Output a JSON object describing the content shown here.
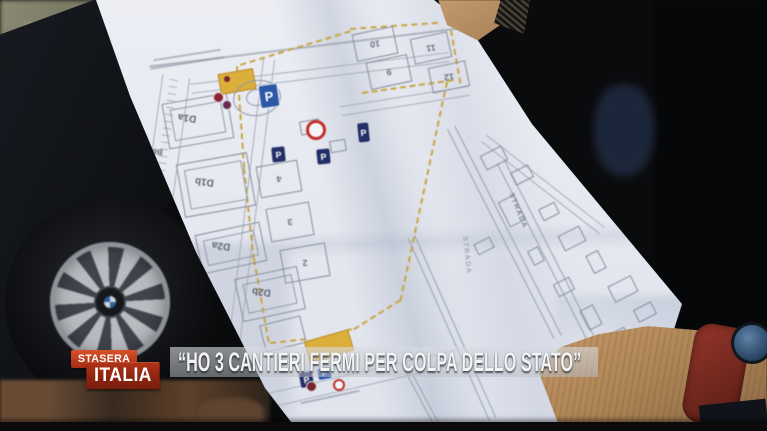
{
  "broadcast": {
    "logo": {
      "line1": "STASERA",
      "line2": "ITALIA"
    },
    "quote": "“HO 3 CANTIERI FERMI PER COLPA DELLO STATO”"
  },
  "map": {
    "labels": {
      "d1a": "D1a",
      "b8c": "B8c",
      "d1b": "D1b",
      "d2a": "D2a",
      "d2b": "D2b",
      "n2": "2",
      "n3": "3",
      "n4": "4",
      "n9": "9",
      "n10": "10",
      "n11": "11",
      "n12": "12"
    },
    "signs": {
      "parking": "P",
      "strada": "STRADA"
    }
  },
  "colors": {
    "boundary_yellow": "#c9a440",
    "parking_blue": "#2b57a8",
    "no_entry_red": "#c03028",
    "logo_red": "#8c2410",
    "logo_orange": "#c64a22",
    "banner_text": "#f2f3f5"
  }
}
